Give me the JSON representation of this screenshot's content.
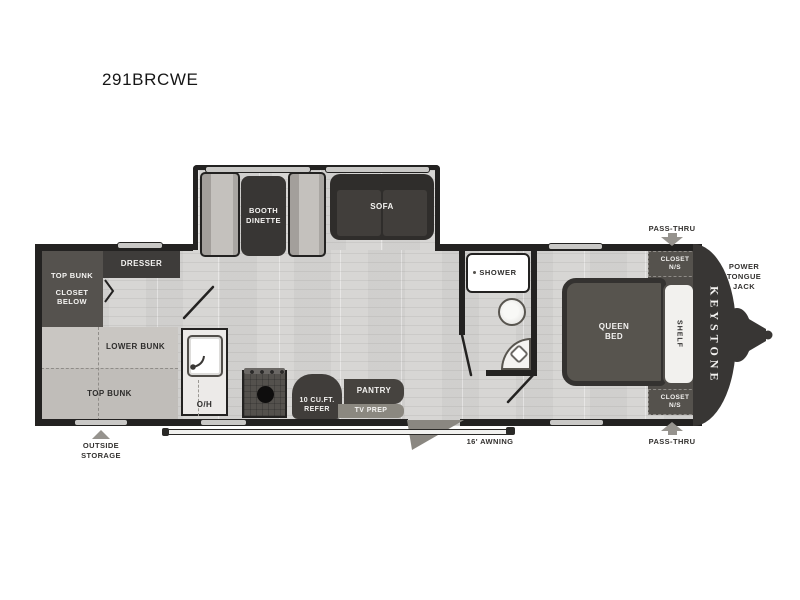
{
  "title": "291BRCWE",
  "brand_logo": "KEYSTONE",
  "exterior": {
    "pass_thru_top": "PASS-THRU",
    "pass_thru_bottom": "PASS-THRU",
    "power_tongue_jack": "POWER\nTONGUE\nJACK",
    "outside_storage": "OUTSIDE\nSTORAGE",
    "awning": "16' AWNING"
  },
  "rooms": {
    "bunk_room": {
      "dresser": "DRESSER",
      "top_bunk_upper": "TOP BUNK",
      "closet_below": "CLOSET\nBELOW",
      "lower_bunk": "LOWER BUNK",
      "top_bunk_lower": "TOP BUNK"
    },
    "living_area": {
      "booth_dinette": "BOOTH\nDINETTE",
      "sofa": "SOFA"
    },
    "kitchen": {
      "overhead_cabinet": "O/H",
      "refrigerator": "10 CU.FT.\nREFER",
      "pantry": "PANTRY",
      "tv_prep": "TV PREP"
    },
    "bathroom": {
      "shower": "SHOWER"
    },
    "bedroom": {
      "queen_bed": "QUEEN\nBED",
      "shelf": "SHELF",
      "closet_front_top": "CLOSET\nN/S",
      "closet_front_bottom": "CLOSET\nN/S"
    }
  },
  "colors": {
    "wall": "#232221",
    "dark_furniture": "#3e3c3a",
    "floor": "#d7d6d4",
    "bench": "#b7b4b0",
    "arrow_gray": "#96938e",
    "background": "#ffffff"
  }
}
